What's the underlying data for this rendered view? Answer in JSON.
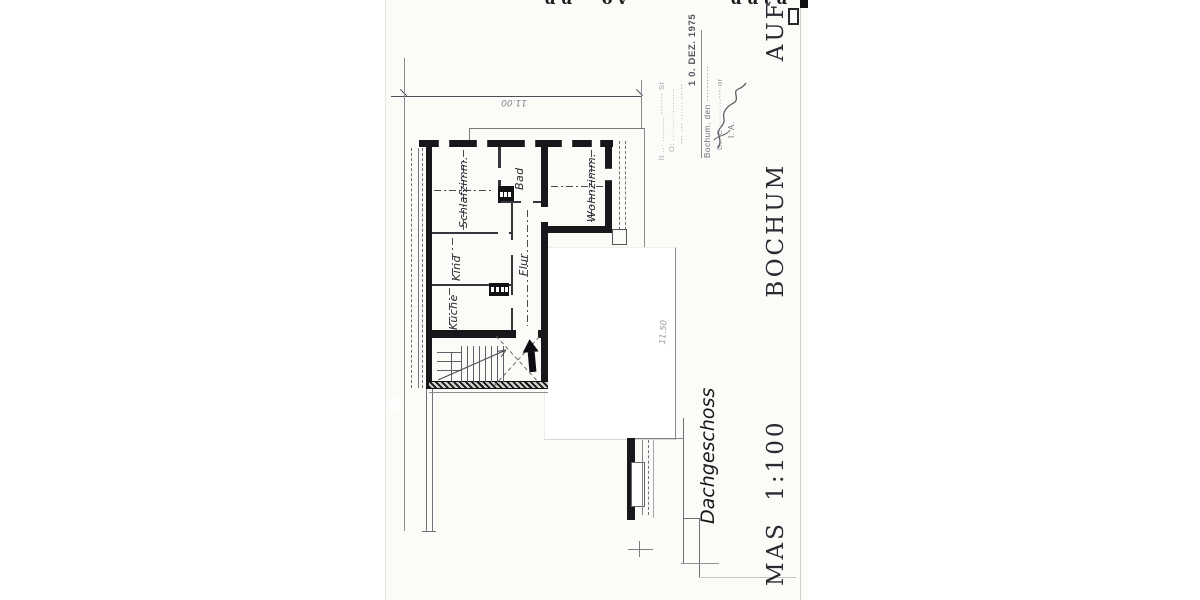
{
  "scan": {
    "top_edge_fragments": "uu ov    uutu    uuruxuuv     o",
    "title_vertical": "MAS 1:100      BOCHUM     AUF  DEM  DAHL,",
    "floor_label": "Dachgeschoss"
  },
  "plan": {
    "rooms": [
      {
        "label": "Schlafzimm."
      },
      {
        "label": "Bad"
      },
      {
        "label": "Wohnzimm."
      },
      {
        "label": "Kind"
      },
      {
        "label": "Flur"
      },
      {
        "label": "Küche"
      }
    ],
    "dimensions": [
      {
        "label": "11.00"
      },
      {
        "label": "11.50"
      }
    ]
  },
  "stamp": {
    "faint_line_1": "lt ..· ......... ---·--- St",
    "faint_line_2": "O: ...·....·..........",
    "faint_line_3": "--- ·-- ······ --·--",
    "date": "1 0. DEZ. 1975",
    "city_line": "Bochum, den ···········",
    "dept_line": "D.· C··········---·or",
    "ia_label": "I. A."
  }
}
